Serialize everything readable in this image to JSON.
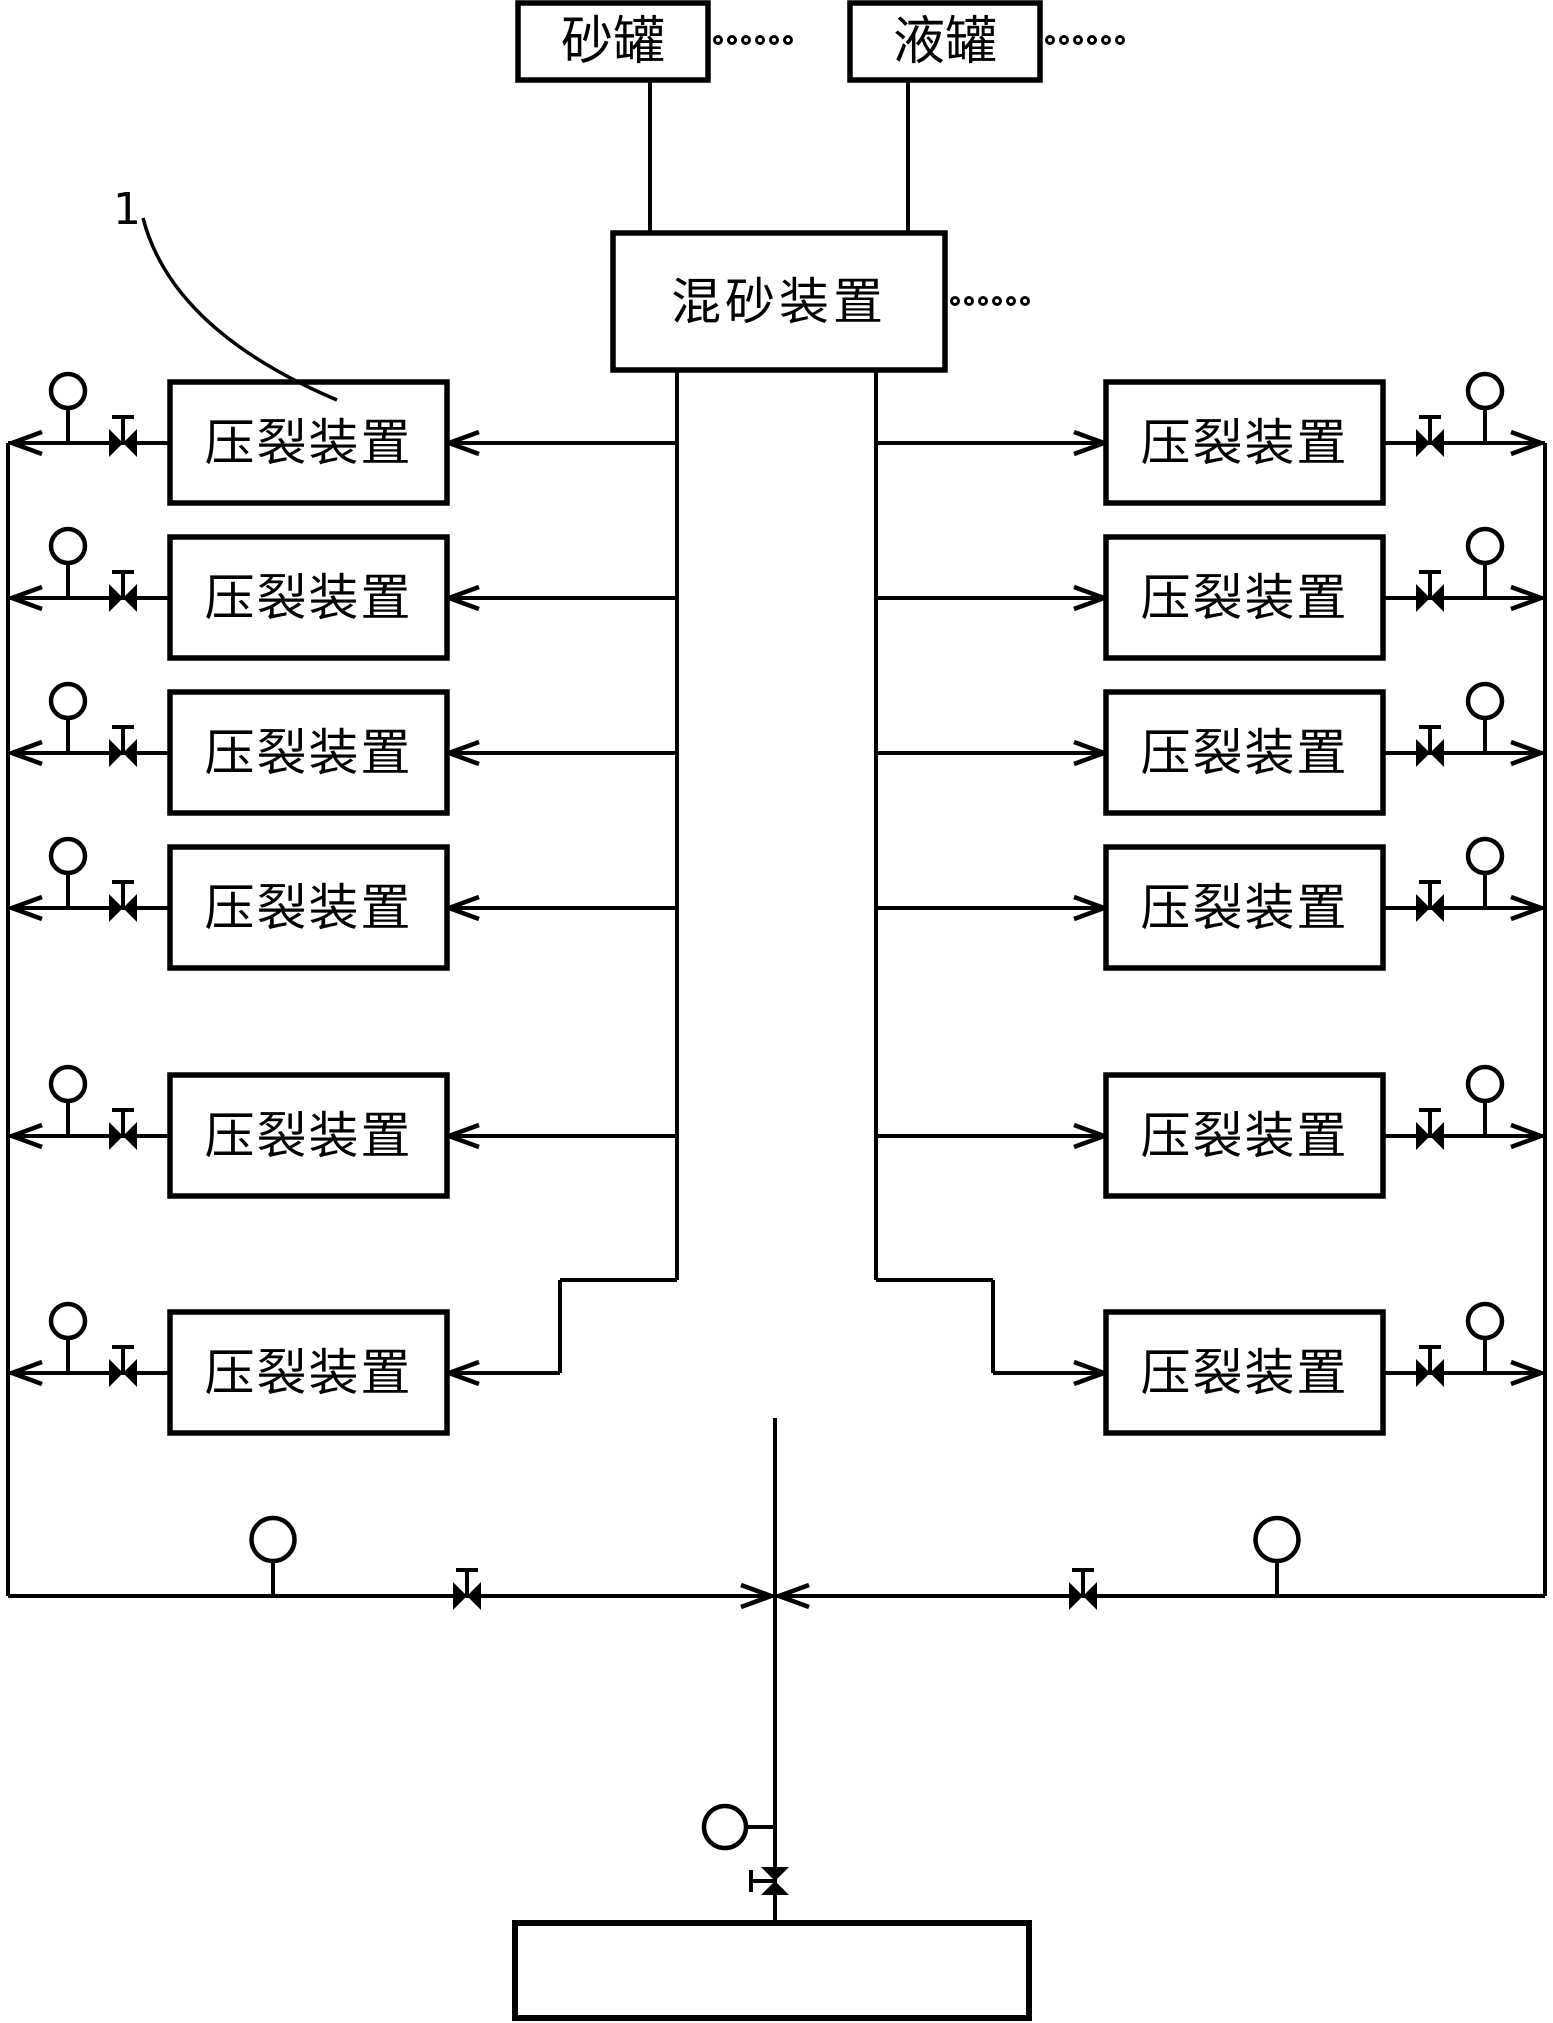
{
  "page": {
    "background": "#ffffff",
    "ink_color": "#000000",
    "width": 1553,
    "height": 2023
  },
  "labels": {
    "sand_tank": "砂罐",
    "liquid_tank": "液罐",
    "mixer": "混砂装置",
    "frac_unit": "压裂装置",
    "ref_numeral": "1"
  },
  "reference": {
    "numeral": "1",
    "points_to_label": "压裂装置"
  },
  "ellipsis_dots": {
    "after_sand_tank": 6,
    "after_liquid_tank": 6,
    "after_mixer": 6
  },
  "columns": {
    "left_unit_count": 6,
    "right_unit_count": 6
  },
  "symbols": {
    "gauge": "pressure-gauge-icon",
    "valve_horizontal": "gate-valve-icon",
    "valve_vertical": "gate-valve-vertical-icon",
    "arrow": "flow-arrow-icon"
  },
  "bottom_box_label": ""
}
